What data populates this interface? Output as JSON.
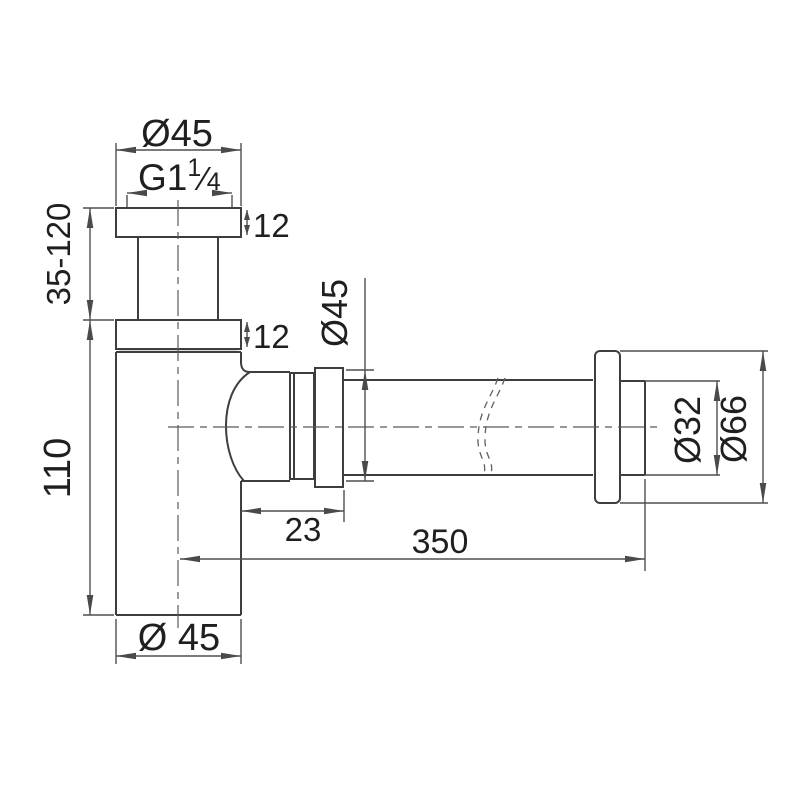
{
  "page": {
    "background": "#ffffff"
  },
  "drawing": {
    "type": "technical-dimension-drawing",
    "subject": "bottle-trap-siphon",
    "line_color": "#3e3e3e",
    "dim_color": "#4f4f4f",
    "labels": {
      "inlet_flange_diameter": "Ø45",
      "thread": {
        "prefix": "G1",
        "numerator": "1",
        "slash": "⁄",
        "denominator": "4"
      },
      "inlet_flange_thickness": "12",
      "riser_height_range": "35-120",
      "lower_flange_thickness": "12",
      "body_height": "110",
      "body_diameter": "Ø 45",
      "outlet_nut_diameter": "Ø45",
      "outlet_offset": "23",
      "pipe_length": "350",
      "tail_pipe_diameter": "Ø32",
      "wall_flange_diameter": "Ø66"
    }
  }
}
